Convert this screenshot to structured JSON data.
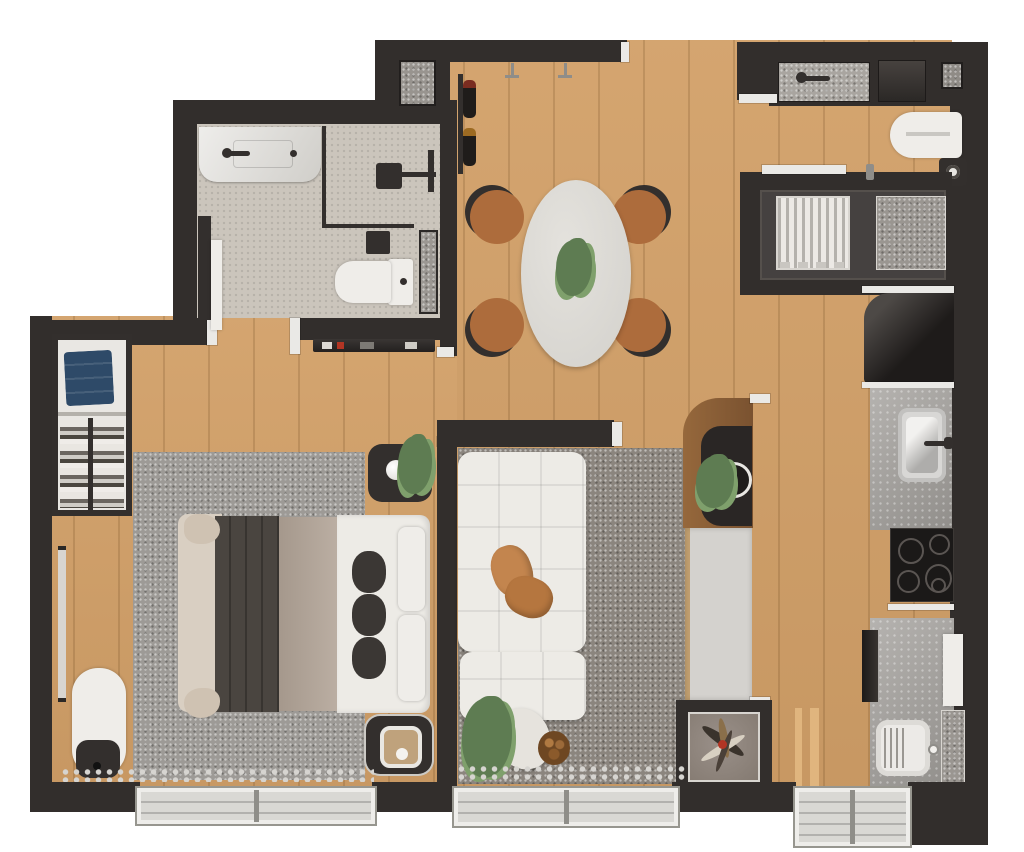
{
  "meta": {
    "content_type": "3d-rendered-floor-plan",
    "view": "top-down",
    "canvas": {
      "width_px": 1024,
      "height_px": 852
    }
  },
  "palette": {
    "background": "#ffffff",
    "wall": "#322e2c",
    "wall_cap": "#eae9e6",
    "wood_floor": "#d2a068",
    "bath_tile": "#cbc5bc",
    "bedroom_rug": "#9d9a96",
    "living_rug": "#8b857e",
    "white_fixture": "#efede9",
    "dark_fixture": "#332f2d",
    "marble": "#a5a29e",
    "steel": "#c9c9c7",
    "cooktop": "#1b1918",
    "fridge": "#262321",
    "sofa": "#edebe6",
    "pillow_tan": "#c3854e",
    "plant": "#5e7c52",
    "denim": "#2e4a68",
    "tech_floor": "#454140",
    "niche_floor": "#8e847b",
    "wood_console": "#8a5e38",
    "chair_seat": "#ad6c3c",
    "accent_red": "#b23524"
  },
  "legend": {
    "rooms": [
      {
        "name": "bathroom",
        "items": [
          "marble-vanity",
          "basin-faucet",
          "shower-glass-screen",
          "shower-head",
          "toilet",
          "wall-niche-mat",
          "door-leaf"
        ]
      },
      {
        "name": "bedroom",
        "items": [
          "double-bed",
          "dark-duvet",
          "beige-runner",
          "pillows",
          "three-dark-cushions",
          "area-rug",
          "nightstand-with-lamp-and-plant",
          "nightstand-with-tray",
          "open-wardrobe",
          "folded-blue-clothes",
          "hanging-rail",
          "full-length-mirror",
          "chaise-bench",
          "dark-pouf",
          "wall-shelf-with-accessories",
          "curtain",
          "window"
        ]
      },
      {
        "name": "dining-area",
        "items": [
          "oval-table",
          "four-chairs",
          "plant-centerpiece",
          "wall-wine-rack",
          "two-wall-sconces",
          "ventilation-shaft"
        ]
      },
      {
        "name": "laundry-area",
        "items": [
          "laundry-sink",
          "sink-faucet",
          "washing-machine",
          "corner-shaft",
          "ironing-board",
          "waste-bin",
          "sliding-door"
        ]
      },
      {
        "name": "technical-area",
        "items": [
          "ac-condenser-unit",
          "gravel-mat"
        ]
      },
      {
        "name": "kitchen",
        "items": [
          "refrigerator",
          "marble-counter",
          "steel-sink",
          "sink-faucet",
          "cooktop-four-burners",
          "lower-counter",
          "washboard-sink",
          "appliance-front",
          "white-panel",
          "floor-mat",
          "towel-ladder",
          "balcony-door"
        ]
      },
      {
        "name": "living-room",
        "items": [
          "modular-sofa",
          "two-tan-pillows",
          "area-rug",
          "planter-pot",
          "log-basket",
          "media-console",
          "rounded-joinery-top",
          "round-tray",
          "console-plant",
          "tv-panel",
          "decor-niche-dried-arrangement",
          "curtain",
          "window"
        ]
      }
    ]
  }
}
